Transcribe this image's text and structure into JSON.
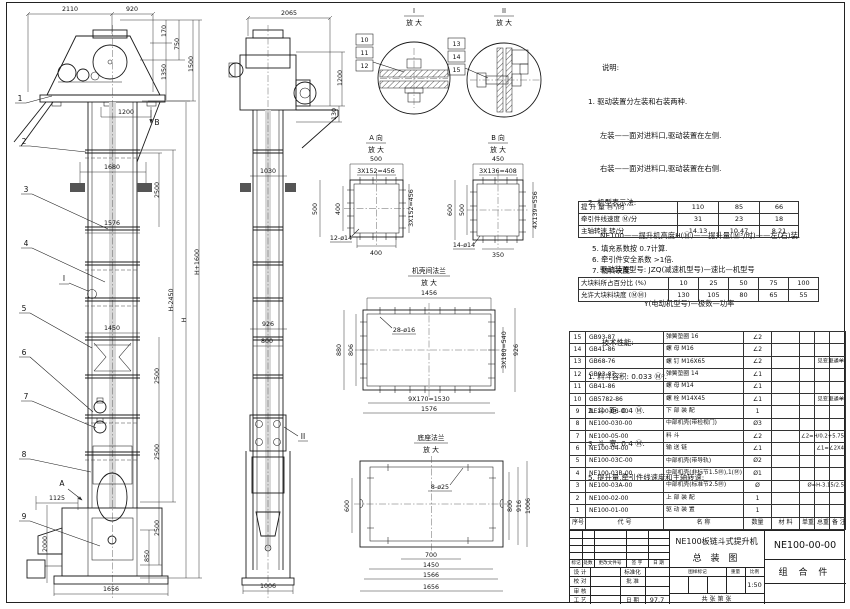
{
  "notes": {
    "lines": [
      "说明:",
      "1. 驱动装置分左装和右装两种.",
      "左装——面对进料口,驱动装置在左侧.",
      "右装——面对进料口,驱动装置在右侧.",
      "2. 机型表示法:",
      "NE100——提升机高度H(Ⓜ)——提升量(Ⓜ³/时)——左(右)装.",
      "驱动装置型号: JZQ(减速机型号)—速比—机型号",
      "Y(电动机型号)—极数—功率",
      "技术性能:",
      "1. 料斗容积: 0.033 Ⓜ³.",
      "2. 斗  距: 0.4 Ⓜ.",
      "3. 斗  宽: 0.4 Ⓜ.",
      "5. 提升量,牵引件线速度和主轴转速:"
    ],
    "post": [
      "5. 填充系数按 0.7计算.",
      "6. 牵引件安全系数 >1倍.",
      "7. 物料块度:"
    ]
  },
  "lift": {
    "rows": [
      {
        "label": "提 升 量   Ⓜ³/时",
        "v1": "110",
        "v2": "85",
        "v3": "66"
      },
      {
        "label": "牵引件线速度 Ⓜ/分",
        "v1": "31",
        "v2": "23",
        "v3": "18"
      },
      {
        "label": "主轴转速   转/分",
        "v1": "14.13",
        "v2": "10.47",
        "v3": "8.21"
      }
    ]
  },
  "lump": {
    "r1l": "大块料所占百分比 (%)",
    "r1": [
      "10",
      "25",
      "50",
      "75",
      "100"
    ],
    "r2l": "允许大块料块度 (ⓂⓂ)",
    "r2": [
      "130",
      "105",
      "80",
      "65",
      "55"
    ]
  },
  "parts": {
    "h": {
      "no": "序号",
      "code": "代  号",
      "name": "名  称",
      "qty": "数量",
      "mat": "材 料",
      "uw": "单重",
      "tw": "总重",
      "rem": "备 注"
    },
    "rows": [
      {
        "no": "15",
        "code": "GB93-87",
        "name": "弹簧垫圈 16",
        "qty": "∠2",
        "rem": ""
      },
      {
        "no": "14",
        "code": "GB41-86",
        "name": "螺  母  M16",
        "qty": "∠2",
        "rem": ""
      },
      {
        "no": "13",
        "code": "GB68-76",
        "name": "螺  钉  M16X65",
        "qty": "∠2",
        "rem": "见变更通单"
      },
      {
        "no": "12",
        "code": "GB93-87",
        "name": "弹簧垫圈 14",
        "qty": "∠1",
        "rem": ""
      },
      {
        "no": "11",
        "code": "GB41-86",
        "name": "螺  母  M14",
        "qty": "∠1",
        "rem": ""
      },
      {
        "no": "10",
        "code": "GB5782-86",
        "name": "螺  栓  M14X45",
        "qty": "∠1",
        "rem": "见变更通单"
      },
      {
        "no": "9",
        "code": "NE100-06-00",
        "name": "下 部 装 配",
        "qty": "1",
        "rem": ""
      },
      {
        "no": "8",
        "code": "NE100-030-00",
        "name": "中部机壳(带检视门)",
        "qty": "Ø3",
        "rem": ""
      },
      {
        "no": "7",
        "code": "NE100-05-00",
        "name": "料  斗",
        "qty": "∠2",
        "rem": "∠2=H/0.2+5.75"
      },
      {
        "no": "6",
        "code": "NE100-04-00",
        "name": "输 送 链",
        "qty": "∠1",
        "rem": "∠1=∠2X4"
      },
      {
        "no": "5",
        "code": "NE100-03C-00",
        "name": "中部机壳(带导轨)",
        "qty": "Ø2",
        "rem": ""
      },
      {
        "no": "4",
        "code": "NE100-03B-00",
        "name": "中部机壳(非标节1.5Ⓜ),1(Ⓜ)",
        "qty": "Ø1",
        "rem": ""
      },
      {
        "no": "3",
        "code": "NE100-03A-00",
        "name": "中部机壳(标准节2.5Ⓜ)",
        "qty": "Ø",
        "rem": "Ø=H-3.15/2.5"
      },
      {
        "no": "2",
        "code": "NE100-02-00",
        "name": "上 部 装 配",
        "qty": "1",
        "rem": ""
      },
      {
        "no": "1",
        "code": "NE100-01-00",
        "name": "驱 动 装 置",
        "qty": "1",
        "rem": ""
      }
    ]
  },
  "tb": {
    "rev": [
      "标记",
      "处数",
      "更改文件号",
      "签 字",
      "日 期"
    ],
    "s1": "设 计",
    "s2": "校 对",
    "s3": "审 核",
    "s4": "工 艺",
    "r1": "标准化",
    "r2": "批 准",
    "r3": "",
    "r4": "日 期",
    "date": "97.7",
    "t1": "NE100板链斗式提升机",
    "t2": "总  装  图",
    "gb": "图样标记",
    "wt": "重量",
    "bl": "比例",
    "scale": "1:50",
    "sheets": "共  张 第  张",
    "no": "NE100-00-00",
    "cls": "组 合 件"
  },
  "fv": {
    "d2110": "2110",
    "d920": "920",
    "d170": "170",
    "d750": "750",
    "d1350": "1350",
    "d1500": "1500",
    "d1200": "1200",
    "d1680": "1680",
    "d2500": "2500",
    "d1576": "1576",
    "dhm": "H-2450",
    "dh": "H",
    "dhp": "H+1600",
    "d1450": "1450",
    "d1125": "1125",
    "d2000": "2000",
    "d850": "850",
    "d1656": "1656",
    "b1": "1",
    "b2": "2",
    "b3": "3",
    "b4": "4",
    "b5": "5",
    "b6": "6",
    "b7": "7",
    "b8": "8",
    "b9": "9",
    "mi": "I",
    "ma": "A",
    "mb": "B"
  },
  "sv": {
    "d2065": "2065",
    "d1200": "1200",
    "d130": "130",
    "d1030": "1030",
    "d926": "926",
    "d800": "800",
    "d1006": "1006",
    "mii": "II"
  },
  "di": {
    "l": "I",
    "s": "放 大",
    "b10": "10",
    "b11": "11",
    "b12": "12"
  },
  "dii": {
    "l": "II",
    "s": "放 大",
    "b13": "13",
    "b14": "14",
    "b15": "15"
  },
  "va": {
    "l": "A 向",
    "s": "放 大",
    "t1": "500",
    "t2": "3X152=456",
    "l1": "500",
    "l2": "400",
    "r1": "3X152=456",
    "bt": "400",
    "h": "12-ø14"
  },
  "vb": {
    "l": "B 向",
    "s": "放 大",
    "t1": "450",
    "t2": "3X136=408",
    "l1": "600",
    "l2": "500",
    "r1": "4X139=556",
    "bt": "350",
    "h": "14-ø14"
  },
  "vf": {
    "l": "机壳间法兰",
    "s": "放 大",
    "t1": "1456",
    "h": "28-ø16",
    "l1": "880",
    "l2": "806",
    "r1": "3X180=540",
    "r2": "926",
    "b1": "9X170=1530",
    "b2": "1576"
  },
  "vg": {
    "l": "底座法兰",
    "s": "放 大",
    "h": "8-ø25",
    "l1": "600",
    "r1": "800",
    "r2": "916",
    "r3": "1006",
    "b1": "700",
    "b2": "1450",
    "b3": "1566",
    "b4": "1656"
  }
}
